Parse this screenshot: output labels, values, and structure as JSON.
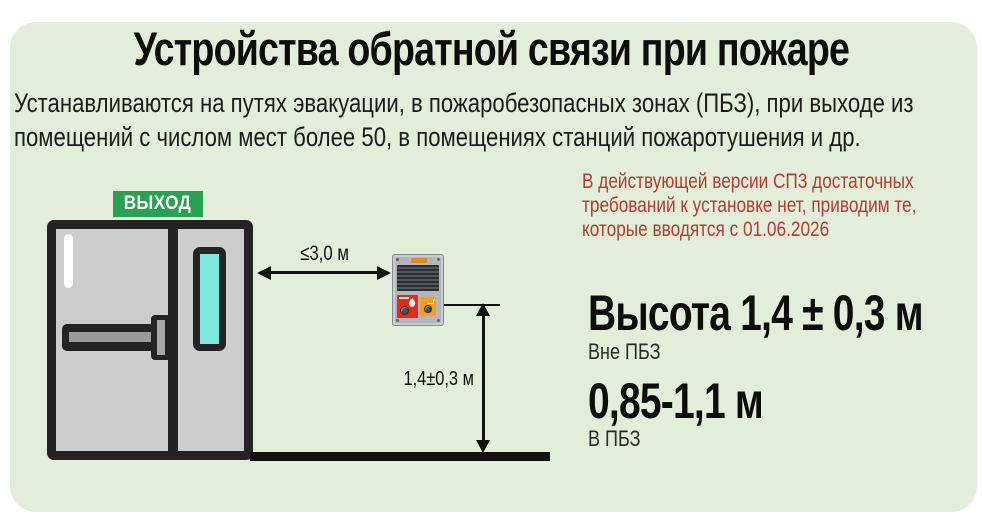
{
  "header": {
    "title": "Устройства обратной связи при пожаре",
    "subtitle_lines": [
      "Устанавливаются на путях эвакуации, в пожаробезопасных зонах (ПБЗ), при выходе из",
      "помещений с числом мест более 50, в помещениях станций пожаротушения и др."
    ]
  },
  "note": {
    "lines": [
      "В действующей версии СП3 достаточных",
      "требований к установке нет, приводим те,",
      "которые вводятся с 01.06.2026"
    ],
    "color": "#b33c32"
  },
  "diagram": {
    "exit_sign_label": "ВЫХОД",
    "horizontal_distance_label": "≤3,0 м",
    "vertical_distance_label": "1,4±0,3 м"
  },
  "specs": {
    "outside_pbz": {
      "value": "Высота 1,4 ± 0,3 м",
      "caption": "Вне ПБЗ"
    },
    "inside_pbz": {
      "value": "0,85-1,1 м",
      "caption": "В ПБЗ"
    }
  },
  "colors": {
    "panel_background": "#e2eed9",
    "exit_sign_green": "#2aa150",
    "note_red": "#b33c32",
    "door_gray": "#cdcdcd",
    "window_cyan": "#7fe9df",
    "fire_button_red": "#dd2b1c",
    "call_button_orange": "#f0a01e"
  }
}
